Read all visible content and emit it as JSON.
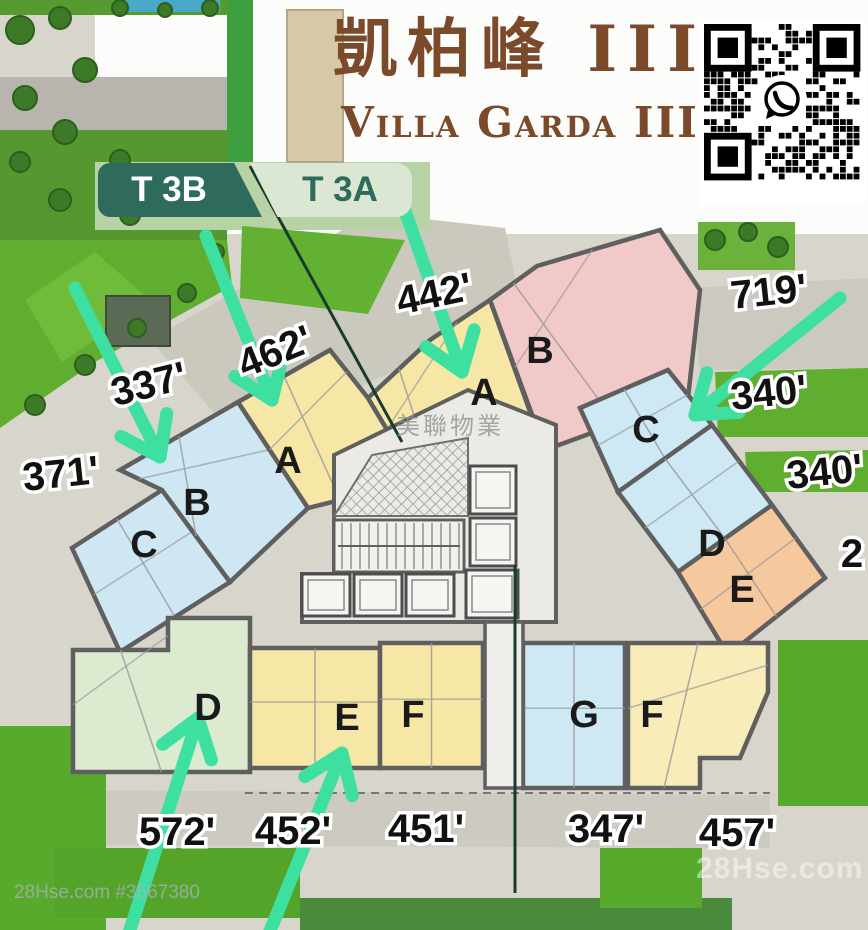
{
  "title": {
    "chinese": "凱柏峰 III",
    "english": "Villa Garda III",
    "color": "#7b4a2b"
  },
  "towers": [
    {
      "id": "T 3B",
      "bg": "#2e6b5d",
      "fg": "#ffffff"
    },
    {
      "id": "T 3A",
      "bg": "#dbe7d2",
      "fg": "#2e6b5d"
    }
  ],
  "watermarks": {
    "center": "美聯物業",
    "bottom_left": "28Hse.com #3567380",
    "bottom_right": "28Hse.com"
  },
  "qr": {
    "label": "whatsapp-contact-qr-code"
  },
  "palette": {
    "arrow": "#3ee0a1",
    "wall": "#5f5f5f",
    "paving": "#d8d5cc",
    "grass": "#5fae2f",
    "boundary_line": "#173c2c"
  },
  "units": [
    {
      "letter": "C",
      "name": "unit-c-t3b",
      "color": "#cfe7f2",
      "poly": [
        [
          72,
          548
        ],
        [
          162,
          490
        ],
        [
          230,
          582
        ],
        [
          120,
          652
        ]
      ],
      "lx": 144,
      "ly": 547
    },
    {
      "letter": "B",
      "name": "unit-b-t3b",
      "color": "#cfe7f2",
      "poly": [
        [
          120,
          470
        ],
        [
          238,
          402
        ],
        [
          308,
          508
        ],
        [
          230,
          582
        ],
        [
          162,
          490
        ]
      ],
      "lx": 197,
      "ly": 505
    },
    {
      "letter": "A",
      "name": "unit-a-t3b",
      "color": "#f6e7a6",
      "poly": [
        [
          238,
          402
        ],
        [
          330,
          350
        ],
        [
          368,
          398
        ],
        [
          410,
          468
        ],
        [
          372,
          492
        ],
        [
          308,
          508
        ]
      ],
      "lx": 288,
      "ly": 463
    },
    {
      "letter": "A",
      "name": "unit-a-t3a",
      "color": "#f6e7a6",
      "poly": [
        [
          368,
          398
        ],
        [
          430,
          340
        ],
        [
          490,
          300
        ],
        [
          543,
          448
        ],
        [
          470,
          522
        ],
        [
          410,
          468
        ]
      ],
      "lx": 484,
      "ly": 395
    },
    {
      "letter": "B",
      "name": "unit-b-t3a",
      "color": "#f1c9c8",
      "poly": [
        [
          490,
          300
        ],
        [
          537,
          266
        ],
        [
          660,
          230
        ],
        [
          700,
          290
        ],
        [
          688,
          398
        ],
        [
          545,
          450
        ]
      ],
      "lx": 540,
      "ly": 353
    },
    {
      "letter": "C",
      "name": "unit-c-t3a",
      "color": "#cfe9f4",
      "poly": [
        [
          580,
          408
        ],
        [
          668,
          370
        ],
        [
          712,
          425
        ],
        [
          618,
          492
        ]
      ],
      "lx": 646,
      "ly": 432
    },
    {
      "letter": "D",
      "name": "unit-d-t3a",
      "color": "#cfe9f4",
      "poly": [
        [
          618,
          492
        ],
        [
          712,
          425
        ],
        [
          772,
          505
        ],
        [
          678,
          572
        ]
      ],
      "lx": 712,
      "ly": 546
    },
    {
      "letter": "E",
      "name": "unit-e-t3a",
      "color": "#f5c89e",
      "poly": [
        [
          678,
          572
        ],
        [
          772,
          505
        ],
        [
          825,
          578
        ],
        [
          728,
          655
        ]
      ],
      "lx": 742,
      "ly": 592
    },
    {
      "letter": "D",
      "name": "unit-d-t3b",
      "color": "#dcead0",
      "poly": [
        [
          73,
          650
        ],
        [
          168,
          650
        ],
        [
          168,
          618
        ],
        [
          250,
          618
        ],
        [
          250,
          772
        ],
        [
          73,
          772
        ]
      ],
      "lx": 208,
      "ly": 710
    },
    {
      "letter": "E",
      "name": "unit-e-t3b",
      "color": "#f6e7a6",
      "poly": [
        [
          250,
          648
        ],
        [
          380,
          648
        ],
        [
          380,
          768
        ],
        [
          250,
          768
        ]
      ],
      "lx": 347,
      "ly": 720
    },
    {
      "letter": "F",
      "name": "unit-f-t3b",
      "color": "#f6e7a6",
      "poly": [
        [
          380,
          643
        ],
        [
          483,
          643
        ],
        [
          483,
          768
        ],
        [
          380,
          768
        ]
      ],
      "lx": 413,
      "ly": 717
    },
    {
      "letter": "G",
      "name": "unit-g-t3a",
      "color": "#cfe9f4",
      "poly": [
        [
          523,
          643
        ],
        [
          625,
          643
        ],
        [
          625,
          788
        ],
        [
          523,
          788
        ]
      ],
      "lx": 584,
      "ly": 717
    },
    {
      "letter": "F",
      "name": "unit-f-t3a",
      "color": "#f8edb8",
      "poly": [
        [
          628,
          643
        ],
        [
          768,
          643
        ],
        [
          768,
          692
        ],
        [
          740,
          758
        ],
        [
          700,
          758
        ],
        [
          700,
          788
        ],
        [
          628,
          788
        ]
      ],
      "lx": 652,
      "ly": 717
    }
  ],
  "dimensions": [
    {
      "text": "442'",
      "x": 437,
      "y": 307,
      "rot": -12
    },
    {
      "text": "462'",
      "x": 280,
      "y": 364,
      "rot": -22
    },
    {
      "text": "337'",
      "x": 152,
      "y": 397,
      "rot": -14
    },
    {
      "text": "371'",
      "x": 62,
      "y": 487,
      "rot": -6
    },
    {
      "text": "719'",
      "x": 770,
      "y": 305,
      "rot": -6
    },
    {
      "text": "340'",
      "x": 770,
      "y": 406,
      "rot": -6
    },
    {
      "text": "340'",
      "x": 826,
      "y": 485,
      "rot": -6
    },
    {
      "text": "2",
      "x": 852,
      "y": 567,
      "rot": 0
    },
    {
      "text": "572'",
      "x": 177,
      "y": 845,
      "rot": 0
    },
    {
      "text": "452'",
      "x": 293,
      "y": 844,
      "rot": 0
    },
    {
      "text": "451'",
      "x": 426,
      "y": 842,
      "rot": 0
    },
    {
      "text": "347'",
      "x": 606,
      "y": 842,
      "rot": 0
    },
    {
      "text": "457'",
      "x": 737,
      "y": 846,
      "rot": 0
    }
  ],
  "arrows": [
    {
      "from": [
        75,
        288
      ],
      "to": [
        160,
        457
      ]
    },
    {
      "from": [
        206,
        236
      ],
      "to": [
        272,
        400
      ]
    },
    {
      "from": [
        404,
        208
      ],
      "to": [
        462,
        372
      ]
    },
    {
      "from": [
        840,
        298
      ],
      "to": [
        695,
        415
      ]
    },
    {
      "from": [
        128,
        936
      ],
      "to": [
        198,
        718
      ]
    },
    {
      "from": [
        268,
        936
      ],
      "to": [
        342,
        753
      ]
    }
  ],
  "boundary_lines": [
    [
      [
        250,
        166
      ],
      [
        402,
        442
      ]
    ],
    [
      [
        515,
        565
      ],
      [
        515,
        893
      ]
    ]
  ],
  "core": {
    "bg": [
      [
        334,
        455
      ],
      [
        468,
        390
      ],
      [
        556,
        425
      ],
      [
        556,
        622
      ],
      [
        302,
        622
      ],
      [
        302,
        574
      ],
      [
        334,
        574
      ]
    ],
    "lobby": [
      485,
      622,
      38,
      166
    ],
    "elevators": [
      [
        302,
        574,
        48,
        42
      ],
      [
        354,
        574,
        48,
        42
      ],
      [
        406,
        574,
        48,
        42
      ],
      [
        470,
        466,
        46,
        48
      ],
      [
        470,
        518,
        46,
        48
      ],
      [
        466,
        570,
        52,
        48
      ]
    ],
    "hatch": [
      [
        372,
        455
      ],
      [
        468,
        438
      ],
      [
        468,
        516
      ],
      [
        334,
        516
      ]
    ],
    "stairs": [
      334,
      520,
      130,
      52
    ]
  },
  "landscape": {
    "patches": [
      {
        "poly": [
          [
            150,
            340
          ],
          [
            372,
            213
          ],
          [
            505,
            228
          ],
          [
            522,
            312
          ],
          [
            240,
            442
          ]
        ],
        "color": "#cbc8be"
      },
      {
        "poly": [
          [
            690,
            288
          ],
          [
            868,
            278
          ],
          [
            868,
            368
          ],
          [
            700,
            370
          ]
        ],
        "color": "#ccc9c0"
      },
      {
        "poly": [
          [
            55,
            790
          ],
          [
            770,
            795
          ],
          [
            770,
            848
          ],
          [
            55,
            845
          ]
        ],
        "color": "#cdcac1"
      }
    ],
    "grass": [
      {
        "poly": [
          [
            0,
            0
          ],
          [
            230,
            0
          ],
          [
            230,
            15
          ],
          [
            0,
            15
          ]
        ],
        "color": "#569a30"
      },
      {
        "poly": [
          [
            0,
            130
          ],
          [
            227,
            130
          ],
          [
            227,
            242
          ],
          [
            0,
            242
          ]
        ],
        "color": "#56982f"
      },
      {
        "poly": [
          [
            227,
            0
          ],
          [
            253,
            0
          ],
          [
            253,
            180
          ],
          [
            227,
            180
          ]
        ],
        "color": "#3f9e3f"
      },
      {
        "poly": [
          [
            95,
            162
          ],
          [
            430,
            162
          ],
          [
            430,
            230
          ],
          [
            95,
            230
          ]
        ],
        "color": "#b7d2a4"
      },
      {
        "poly": [
          [
            0,
            240
          ],
          [
            227,
            240
          ],
          [
            232,
            286
          ],
          [
            95,
            362
          ],
          [
            0,
            428
          ]
        ],
        "color": "#5fae2f"
      },
      {
        "poly": [
          [
            25,
            300
          ],
          [
            95,
            252
          ],
          [
            152,
            302
          ],
          [
            62,
            362
          ]
        ],
        "color": "#6fbc3a"
      },
      {
        "poly": [
          [
            242,
            226
          ],
          [
            405,
            240
          ],
          [
            368,
            314
          ],
          [
            240,
            298
          ]
        ],
        "color": "#62b133"
      },
      {
        "poly": [
          [
            698,
            222
          ],
          [
            795,
            222
          ],
          [
            795,
            270
          ],
          [
            698,
            270
          ]
        ],
        "color": "#6ab23c"
      },
      {
        "poly": [
          [
            715,
            372
          ],
          [
            868,
            368
          ],
          [
            868,
            437
          ],
          [
            718,
            437
          ]
        ],
        "color": "#5fae2f"
      },
      {
        "poly": [
          [
            745,
            452
          ],
          [
            868,
            450
          ],
          [
            868,
            492
          ],
          [
            748,
            492
          ]
        ],
        "color": "#5fae2f"
      },
      {
        "poly": [
          [
            778,
            640
          ],
          [
            868,
            640
          ],
          [
            868,
            806
          ],
          [
            778,
            806
          ]
        ],
        "color": "#58aa2c"
      },
      {
        "poly": [
          [
            0,
            726
          ],
          [
            106,
            726
          ],
          [
            106,
            930
          ],
          [
            0,
            930
          ]
        ],
        "color": "#58aa2c"
      },
      {
        "poly": [
          [
            55,
            848
          ],
          [
            300,
            848
          ],
          [
            300,
            918
          ],
          [
            55,
            918
          ]
        ],
        "color": "#54a42a"
      },
      {
        "poly": [
          [
            300,
            898
          ],
          [
            732,
            898
          ],
          [
            732,
            930
          ],
          [
            300,
            930
          ]
        ],
        "color": "#4a8a3d"
      },
      {
        "poly": [
          [
            600,
            848
          ],
          [
            702,
            848
          ],
          [
            702,
            908
          ],
          [
            600,
            908
          ]
        ],
        "color": "#58aa2c"
      }
    ],
    "pool": [
      125,
      0,
      95,
      12
    ],
    "wall": [
      0,
      77,
      227,
      53
    ],
    "facade": [
      287,
      10,
      56,
      152
    ],
    "pavilion": [
      106,
      296,
      64,
      50
    ],
    "trees": [
      [
        20,
        30,
        14
      ],
      [
        60,
        18,
        11
      ],
      [
        85,
        70,
        12
      ],
      [
        25,
        98,
        12
      ],
      [
        65,
        132,
        12
      ],
      [
        20,
        162,
        10
      ],
      [
        120,
        8,
        8
      ],
      [
        165,
        10,
        7
      ],
      [
        210,
        8,
        8
      ],
      [
        120,
        160,
        10
      ],
      [
        170,
        180,
        10
      ],
      [
        60,
        200,
        11
      ],
      [
        130,
        215,
        10
      ],
      [
        35,
        405,
        10
      ],
      [
        85,
        365,
        10
      ],
      [
        137,
        328,
        9
      ],
      [
        187,
        293,
        9
      ],
      [
        216,
        252,
        8
      ],
      [
        715,
        240,
        10
      ],
      [
        748,
        232,
        9
      ],
      [
        778,
        247,
        10
      ]
    ]
  }
}
